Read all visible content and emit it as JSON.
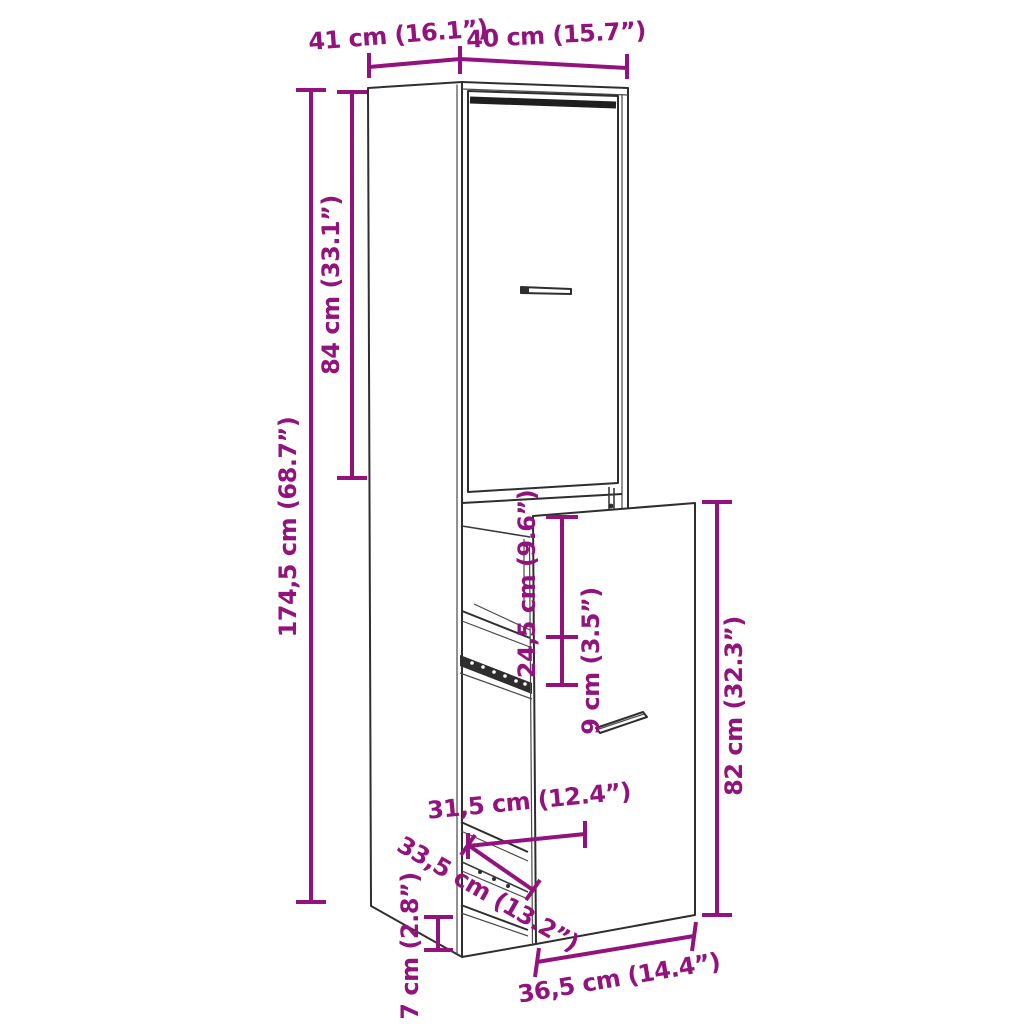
{
  "diagram": {
    "background_color": "#ffffff",
    "accent_color": "#93137d",
    "line_color": "#2e2e2e",
    "labels": {
      "depth_top": "41 cm (16.1”)",
      "width_top": "40 cm (15.7”)",
      "upper_door_height": "84 cm (33.1”)",
      "total_height": "174,5 cm (68.7”)",
      "opening_top_height": "24,5 cm (9.6”)",
      "shelf_spacing": "9 cm (3.5”)",
      "drawer_front_height": "82 cm (32.3”)",
      "inner_depth": "31,5 cm (12.4”)",
      "rail_length": "33,5 cm (13.2”)",
      "plinth_height": "7 cm (2.8”)",
      "drawer_front_width": "36,5 cm (14.4”)"
    }
  }
}
